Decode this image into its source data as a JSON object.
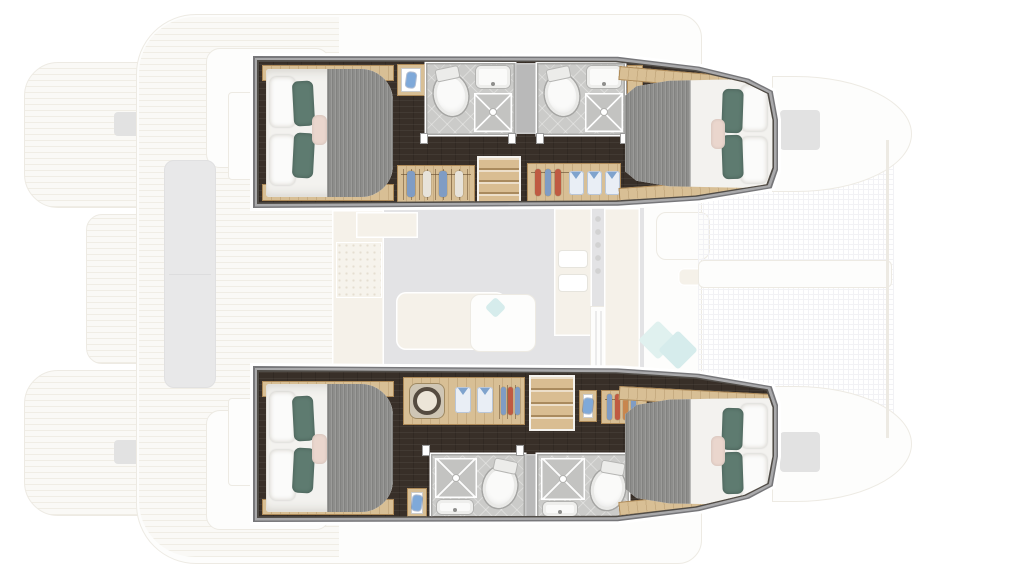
{
  "scene": {
    "subject": "catamaran-floorplan",
    "view": "top-down",
    "highlighted_area": "hull cabins",
    "cabin_count": 4,
    "bathroom_count": 4
  },
  "hulls": [
    {
      "id": "upper-hull",
      "sections": [
        "aft-double-cabin",
        "vanity",
        "bathroom-1",
        "bathroom-2",
        "wardrobe",
        "stairs",
        "wardrobe-with-shirts",
        "forward-double-cabin"
      ]
    },
    {
      "id": "lower-hull",
      "sections": [
        "aft-double-cabin",
        "wardrobe-with-washer",
        "stairs",
        "vanity",
        "wardrobe",
        "bathroom-1",
        "bathroom-2",
        "forward-double-cabin"
      ]
    }
  ],
  "ghost_areas": [
    "stern-platforms",
    "aft-cockpit",
    "saloon",
    "galley",
    "foredeck-lounge",
    "trampoline-net",
    "bow-tips"
  ],
  "palette": {
    "page_bg": "#ffffff",
    "hull_halo": "#ffffff",
    "floor_dark": "#382f28",
    "floor_grain": "rgba(255,255,255,0.05)",
    "wood": "#d8bf95",
    "wood_edge": "#ae8a58",
    "bed_white": "#f3f2ef",
    "blanket_gray": "#8d8d8b",
    "pillow_white": "#fbfbfa",
    "pillow_teal": "#5e7b70",
    "pillow_blush": "#ead6cd",
    "bath_floor": "#cbcbc9",
    "bath_wall": "#b9b9b9",
    "fixture_white": "#fafaf9",
    "shower_tray": "#c3c3c1",
    "stair_wood": "#d9bd92",
    "stair_edge": "#a98a5e",
    "shirt_collar": "#7fa3cd",
    "hanger_red": "#bf5a42",
    "hanger_blue": "#7f9cc4",
    "hanger_orange": "#c8864e",
    "hanger_cream": "#e7e3da",
    "washer_ring": "#554b40",
    "cab_blue": "#7fa9d9",
    "ghost_deck": "#f6f4ee",
    "ghost_teak_line": "#e3ddcd",
    "ghost_line": "#dcd7c9",
    "ghost_gray_floor": "#c9c9cd",
    "ghost_beige": "#ece5d5",
    "ghost_white": "#fcfcfa",
    "ghost_bench": "#d2d2d4",
    "ghost_teal": "#c2e4e0",
    "ghost_teal2": "#aedbda",
    "ghost_hatch": "#c6c6c6",
    "net_line": "#e7e7ec"
  }
}
